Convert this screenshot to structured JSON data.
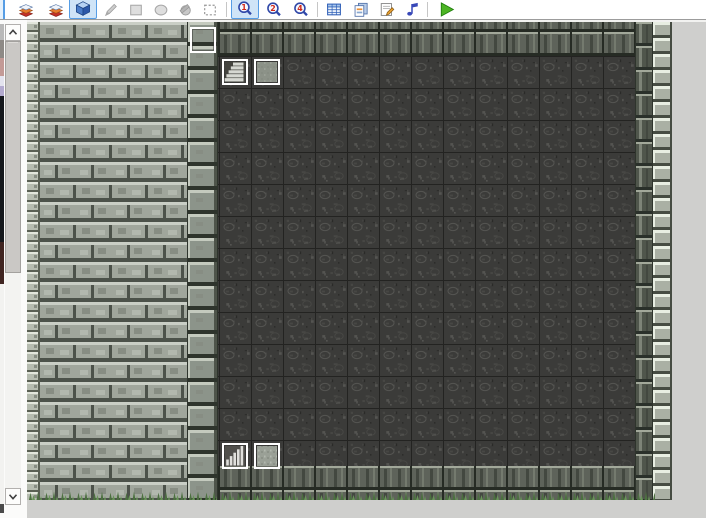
{
  "window": {
    "app": "map-editor",
    "background_color": "#cfcfcd",
    "toolbar_background": "#ffffff"
  },
  "toolbar": {
    "items": [
      {
        "type": "button",
        "id": "layer-1-partial",
        "icon": "partial",
        "state": "selected",
        "x": 0,
        "w": 5
      },
      {
        "type": "button",
        "id": "layer-2",
        "icon": "layers",
        "state": "normal",
        "x": 13,
        "w": 26
      },
      {
        "type": "button",
        "id": "layer-3",
        "icon": "layers",
        "state": "normal",
        "x": 43,
        "w": 26
      },
      {
        "type": "button",
        "id": "event-layer",
        "icon": "cube",
        "state": "selected",
        "x": 69,
        "w": 28
      },
      {
        "type": "button",
        "id": "pencil",
        "icon": "pencil",
        "state": "disabled",
        "x": 99,
        "w": 24
      },
      {
        "type": "button",
        "id": "rectangle",
        "icon": "rectangle",
        "state": "disabled",
        "x": 124,
        "w": 24
      },
      {
        "type": "button",
        "id": "ellipse",
        "icon": "ellipse",
        "state": "disabled",
        "x": 149,
        "w": 24
      },
      {
        "type": "button",
        "id": "flood-fill",
        "icon": "fill",
        "state": "disabled",
        "x": 173,
        "w": 24
      },
      {
        "type": "button",
        "id": "select",
        "icon": "select",
        "state": "disabled",
        "x": 198,
        "w": 24
      },
      {
        "type": "separator",
        "x": 226
      },
      {
        "type": "button",
        "id": "zoom-1-1",
        "icon": "zoom",
        "badge": "1",
        "state": "selected",
        "x": 231,
        "w": 28
      },
      {
        "type": "button",
        "id": "zoom-1-2",
        "icon": "zoom",
        "badge": "2",
        "state": "normal",
        "x": 261,
        "w": 26
      },
      {
        "type": "button",
        "id": "zoom-1-4",
        "icon": "zoom",
        "badge": "4",
        "state": "normal",
        "x": 288,
        "w": 26
      },
      {
        "type": "separator",
        "x": 317
      },
      {
        "type": "button",
        "id": "database",
        "icon": "database",
        "state": "normal",
        "x": 321,
        "w": 26
      },
      {
        "type": "button",
        "id": "materials",
        "icon": "materials",
        "state": "normal",
        "x": 348,
        "w": 26
      },
      {
        "type": "button",
        "id": "script-editor",
        "icon": "script",
        "state": "normal",
        "x": 374,
        "w": 26
      },
      {
        "type": "button",
        "id": "sound-test",
        "icon": "sound",
        "state": "normal",
        "x": 399,
        "w": 26
      },
      {
        "type": "separator",
        "x": 427
      },
      {
        "type": "button",
        "id": "playtest",
        "icon": "play",
        "state": "normal",
        "x": 433,
        "w": 28
      }
    ],
    "zoom_badge_color": "#d02818"
  },
  "palette": {
    "fragments": [
      {
        "y": 4,
        "h": 16,
        "color": "#b9b9b9"
      },
      {
        "y": 20,
        "h": 18,
        "color": "#8e8a86"
      },
      {
        "y": 38,
        "h": 18,
        "color": "#c39a96"
      },
      {
        "y": 56,
        "h": 10,
        "color": "#e3e3ee"
      },
      {
        "y": 66,
        "h": 10,
        "color": "#b3aacf"
      },
      {
        "y": 76,
        "h": 146,
        "color": "#15181d"
      },
      {
        "y": 222,
        "h": 42,
        "color": "#402521"
      },
      {
        "y": 264,
        "h": 220,
        "color": "#f2f2f0"
      },
      {
        "y": 484,
        "h": 9,
        "color": "#4a4a4a"
      }
    ]
  },
  "scrollbar": {
    "height": 481,
    "button_height": 17,
    "thumb_top": 17,
    "thumb_height": 232
  },
  "map": {
    "width": 645,
    "height": 478,
    "tile_size": 32,
    "regions": [
      {
        "name": "left-edge-bricks",
        "x": 0,
        "y": 0,
        "w": 13,
        "h": 478,
        "pattern": "pEdgeL"
      },
      {
        "name": "left-brick-wall",
        "x": 13,
        "y": 0,
        "w": 148,
        "h": 478,
        "pattern": "pWall",
        "ox": 13
      },
      {
        "name": "pillar-column",
        "x": 161,
        "y": 0,
        "w": 30,
        "h": 478,
        "pattern": "pPillar",
        "ox": 11
      },
      {
        "name": "top-wall-band",
        "x": 191,
        "y": 0,
        "w": 418,
        "h": 34,
        "pattern": "pDarkWall",
        "ox": 1,
        "oy": 10
      },
      {
        "name": "stone-floor",
        "x": 191,
        "y": 34,
        "w": 418,
        "h": 410,
        "pattern": "pFloor",
        "ox": 1,
        "oy": 3
      },
      {
        "name": "bottom-wall-band",
        "x": 191,
        "y": 444,
        "w": 418,
        "h": 34,
        "pattern": "pDarkWall2",
        "ox": 1,
        "oy": 12
      },
      {
        "name": "right-dark-column",
        "x": 609,
        "y": 0,
        "w": 17,
        "h": 478,
        "pattern": "pRightDark",
        "ox": 14
      },
      {
        "name": "right-edge-bricks",
        "x": 626,
        "y": 0,
        "w": 19,
        "h": 478,
        "pattern": "pEdgeR",
        "ox": 18
      },
      {
        "name": "grass-fringe",
        "x": 0,
        "y": 464,
        "w": 628,
        "h": 14,
        "pattern": "pGrass",
        "oy": 2
      }
    ],
    "seams": [
      {
        "x": 160,
        "w": 1
      },
      {
        "x": 190,
        "w": 1
      },
      {
        "x": 608,
        "w": 1
      },
      {
        "x": 625,
        "w": 1
      }
    ],
    "events": [
      {
        "id": "event-empty-top",
        "x": 163,
        "y": 5,
        "graphic": "none"
      },
      {
        "id": "event-stairs-upper",
        "x": 195,
        "y": 37,
        "graphic": "stairs-diagonal"
      },
      {
        "id": "event-tile-upper",
        "x": 227,
        "y": 37,
        "graphic": "gray-texture"
      },
      {
        "id": "event-stairs-lower",
        "x": 195,
        "y": 421,
        "graphic": "stairs-front"
      },
      {
        "id": "event-tile-lower",
        "x": 227,
        "y": 421,
        "graphic": "gray-texture-light"
      }
    ],
    "event_size": 26,
    "colors": {
      "wallFace": "#a0a69c",
      "wallHi": "#c9cec5",
      "wallDark": "#4c524a",
      "wallMot1": "#878d83",
      "wallMot2": "#b2b8ae",
      "edgeFace": "#b6bcb0",
      "edgeHi": "#e2e6dc",
      "edgeDark": "#5a6054",
      "pillarFace": "#8c948a",
      "pillarHi": "#c4cabe",
      "pillarShadow": "#4e544a",
      "pillarGap": "#2e342c",
      "floorBase": "#3b3b39",
      "floorHi": "#545451",
      "floorMid": "#474744",
      "floorDark": "#2a2a28",
      "floorGrid": "#232321",
      "dwFace": "#5e635a",
      "dwHi": "#a2a89a",
      "dwStD": "#434840",
      "dwStL": "#747a6e",
      "dwGap": "#262b24",
      "rdFace": "#50564c",
      "rdStL": "#7e8478",
      "rdGap": "#2a302a",
      "reFace": "#aab0a4",
      "reHi": "#e8eee2",
      "reDark": "#464c42",
      "grassD": "#4c7040",
      "grassL": "#689458",
      "evBorder": "#ffffff",
      "evInner": "#383836",
      "evDark": "#44443f",
      "evLight": "#d6d8d2",
      "evMid": "#8a8c86",
      "evBar": "#e0e0dc",
      "evBarBg": "#504f4b",
      "evGray": "#8c9288",
      "evGrayL": "#9aa096"
    }
  }
}
